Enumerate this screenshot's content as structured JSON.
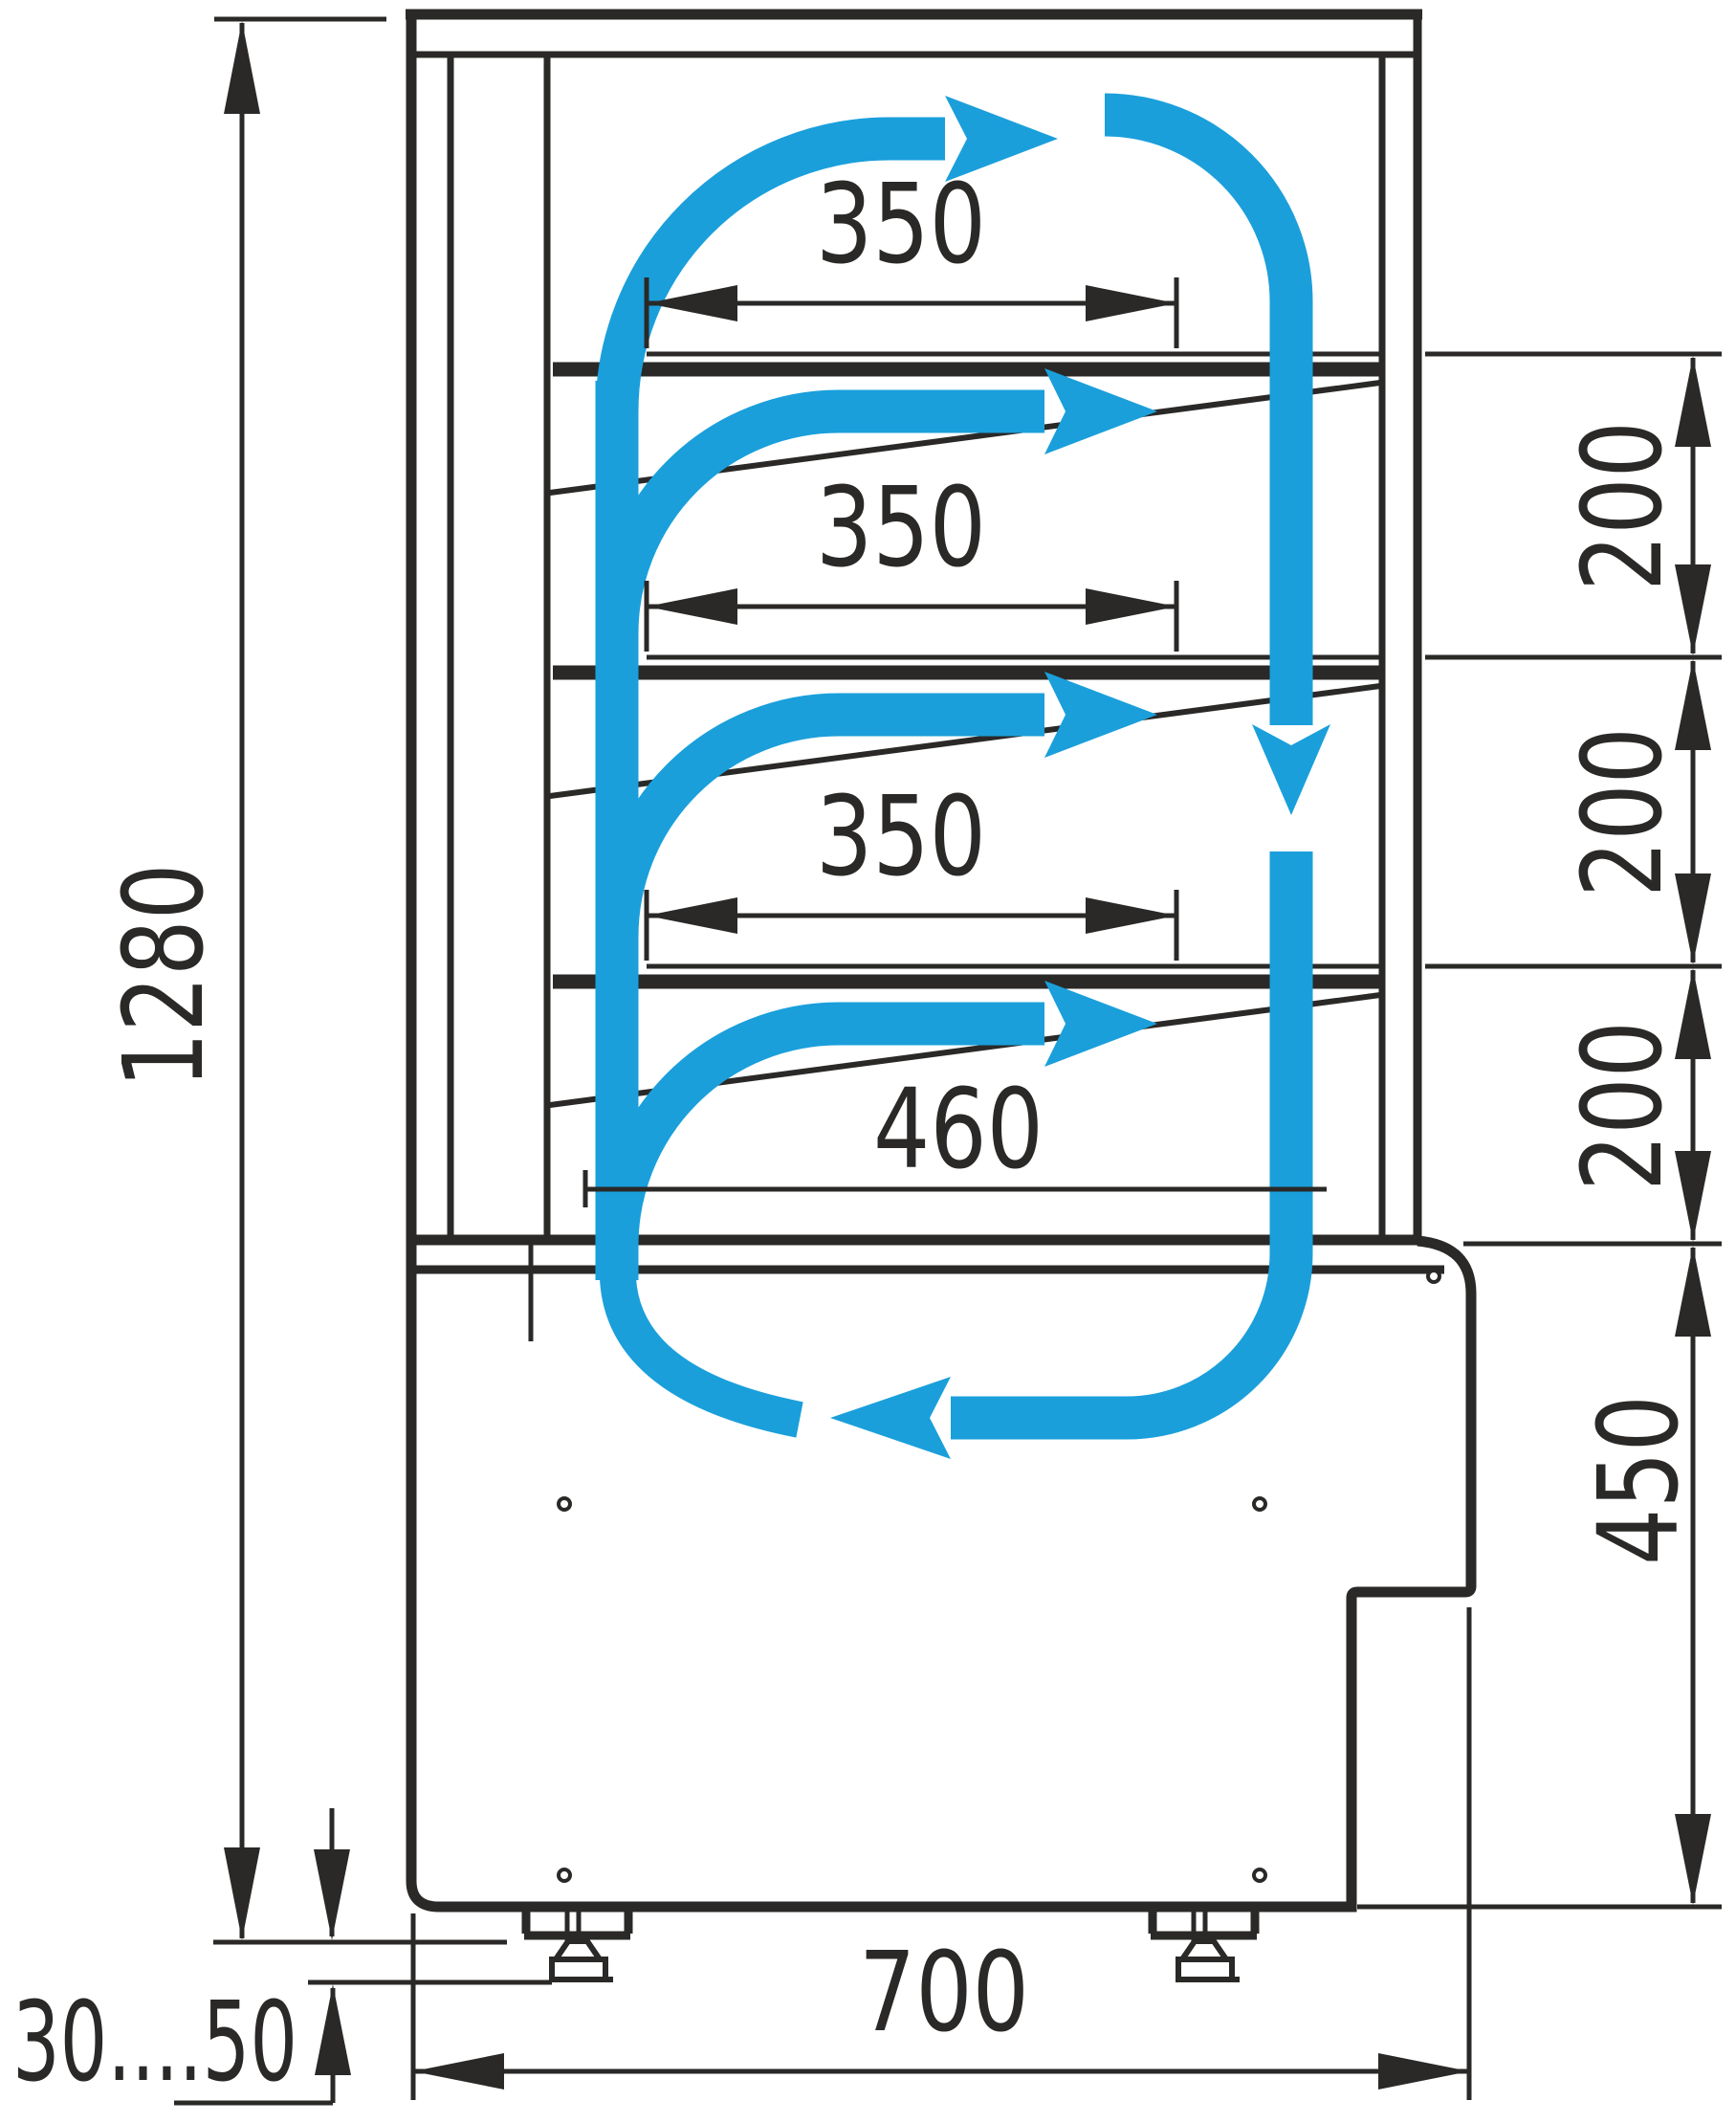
{
  "diagram": {
    "kind": "technical-drawing",
    "subject": "refrigerated-display-case-side-section-with-air-circulation",
    "units": "mm",
    "labels": {
      "overall_height": "1280",
      "shelf_width": "350",
      "shelf_gap": "200",
      "bottom_shelf_width": "460",
      "base_section_height": "450",
      "depth": "700",
      "foot_height_range": "30....50"
    },
    "colors": {
      "line": "#2A2927",
      "airflow": "#1A9FDB",
      "background": "#FFFFFF"
    },
    "icons": {
      "airflow_arrows": "blue-circulation-arrows",
      "dimension_arrows": "black-dimension-arrowheads"
    }
  }
}
